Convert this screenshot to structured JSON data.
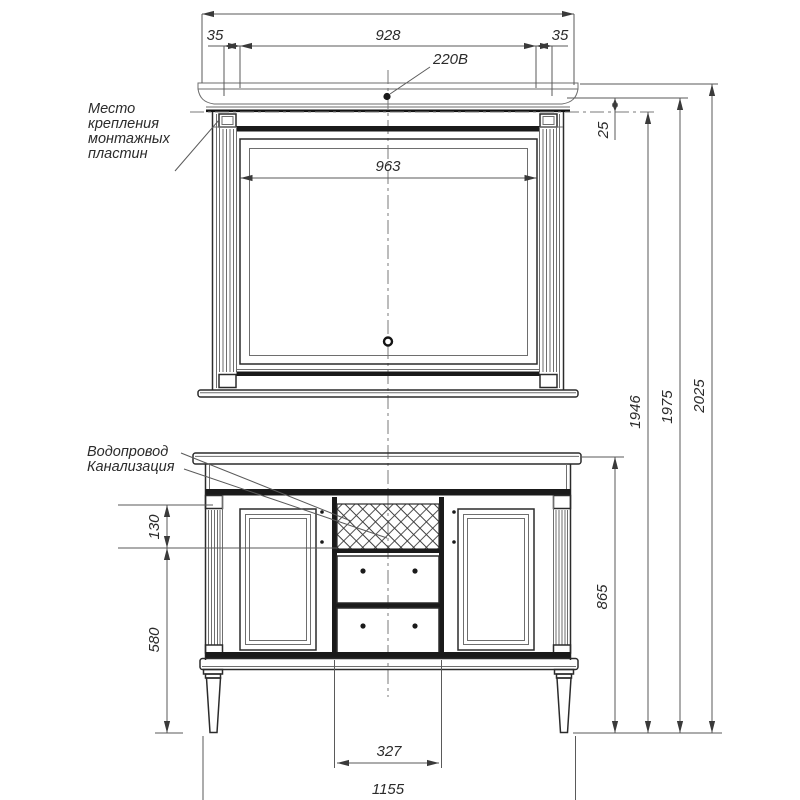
{
  "annotations": {
    "mounting_plates": {
      "lines": [
        "Место",
        "крепления",
        "монтажных",
        "пластин"
      ]
    },
    "plumbing": {
      "lines": [
        "Водопровод",
        "Канализация"
      ]
    },
    "power_label": "220В"
  },
  "dimensions": {
    "offset_left": "35",
    "span_top": "928",
    "offset_right": "35",
    "mirror_inner_width": "963",
    "plate_offset": "25",
    "panel_height": "130",
    "clearance_height": "580",
    "vanity_height": "865",
    "height_to_plates": "1946",
    "height_mid": "1975",
    "height_total": "2025",
    "drawer_span": "327",
    "vanity_width": "1155"
  },
  "colors": {
    "line": "#2b2b2b",
    "thin_line": "#6e6e6e",
    "text": "#2b2b2b",
    "background": "#ffffff"
  }
}
